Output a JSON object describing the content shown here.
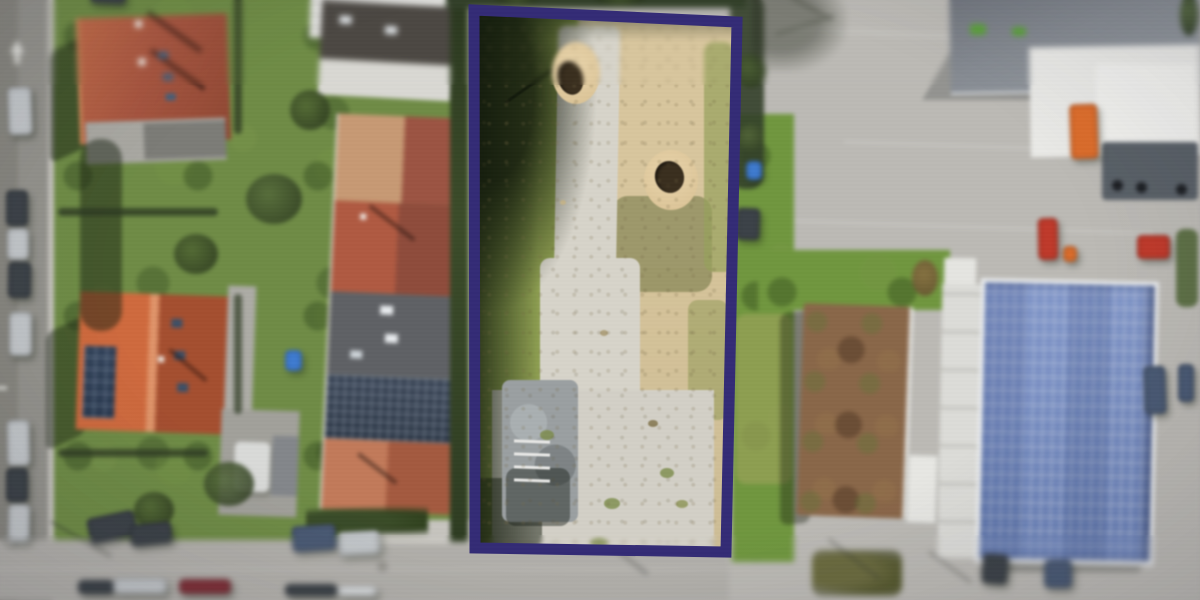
{
  "meta": {
    "description": "Aerial drone photograph of a vacant building plot outlined with a thick purple boundary; residential houses with red roofs and a street with parked cars on the left, commercial yard with a solar-panel roof building on the right"
  },
  "boundary": {
    "points": "474,10 737,22 726,552 475,548",
    "stroke": "#332b76",
    "stroke_width": 11
  },
  "palette": {
    "boundary_purple": "#332b76",
    "road": "#b3b1ac",
    "road_left": "#94938d",
    "sidewalk": "#c7c5bf",
    "pavement": "#bcbab5",
    "grass": "#6f8c46",
    "grass_bright": "#70973f",
    "grass_pale": "#96a156",
    "hedge": "#2d3a23",
    "tree_dark": "#33402a",
    "plot_grass": "#8da050",
    "plot_shadow": "#1e2a17",
    "gravel": "#d7d4ca",
    "sand": "#d8c69e",
    "sand_mound": "#e8d4ab",
    "pit_hole": "#3a2f1f",
    "rubble": "#9ba0a2",
    "roof_red": "#a85a3e",
    "roof_orange": "#c2623a",
    "roof_tan": "#c79a74",
    "roof_darkred": "#9c5443",
    "roof_darkgray": "#45474b",
    "roof_gray": "#5f6165",
    "roof_slate": "#868b92",
    "white_bldg": "#e9e9e6",
    "solar_panel": "#7d92c4",
    "solar_line": "#b9c4dd",
    "greenroof": "#8a6749",
    "truck_orange": "#dc6d2c",
    "vehicle_red": "#bf3a2b",
    "car_silver": "#c3c7ca",
    "car_dark": "#3c4248",
    "car_blue": "#4a5a74",
    "car_maroon": "#7f3038",
    "car_white": "#dde0e2",
    "object_blue": "#3f7bd0"
  },
  "vehicles": [
    {
      "name": "parked-car",
      "x": 14,
      "y": 93,
      "w": 24,
      "h": 48,
      "c": "car_silver",
      "r": -2
    },
    {
      "name": "parked-car",
      "x": 12,
      "y": 196,
      "w": 22,
      "h": 36,
      "c": "car_dark",
      "r": 0
    },
    {
      "name": "parked-car",
      "x": 13,
      "y": 234,
      "w": 22,
      "h": 32,
      "c": "car_silver",
      "r": 0
    },
    {
      "name": "parked-car",
      "x": 14,
      "y": 268,
      "w": 23,
      "h": 36,
      "c": "car_dark",
      "r": 1
    },
    {
      "name": "parked-car",
      "x": 15,
      "y": 318,
      "w": 23,
      "h": 44,
      "c": "car_silver",
      "r": 0
    },
    {
      "name": "parked-car",
      "x": 13,
      "y": 426,
      "w": 23,
      "h": 46,
      "c": "car_silver",
      "r": -1
    },
    {
      "name": "parked-car",
      "x": 12,
      "y": 474,
      "w": 22,
      "h": 34,
      "c": "car_dark",
      "r": 0
    },
    {
      "name": "parked-car",
      "x": 14,
      "y": 510,
      "w": 22,
      "h": 38,
      "c": "car_silver",
      "r": 1
    },
    {
      "name": "parked-car",
      "x": 96,
      "y": -8,
      "w": 36,
      "h": 18,
      "c": "car_dark",
      "r": 3
    },
    {
      "name": "parked-car",
      "x": 94,
      "y": 520,
      "w": 48,
      "h": 26,
      "c": "car_dark",
      "r": -12
    },
    {
      "name": "parked-car",
      "x": 136,
      "y": 529,
      "w": 42,
      "h": 22,
      "c": "car_dark",
      "r": -6
    },
    {
      "name": "parked-car",
      "x": 298,
      "y": 531,
      "w": 44,
      "h": 26,
      "c": "car_blue",
      "r": -4
    },
    {
      "name": "parked-car",
      "x": 344,
      "y": 537,
      "w": 42,
      "h": 24,
      "c": "car_silver",
      "r": -3
    },
    {
      "name": "parked-car",
      "x": 84,
      "y": 586,
      "w": 36,
      "h": 14,
      "c": "car_dark",
      "r": 0
    },
    {
      "name": "parked-car",
      "x": 119,
      "y": 584,
      "w": 54,
      "h": 16,
      "c": "car_silver",
      "r": 0
    },
    {
      "name": "parked-car",
      "x": 185,
      "y": 585,
      "w": 52,
      "h": 15,
      "c": "car_maroon",
      "r": 0
    },
    {
      "name": "parked-car",
      "x": 291,
      "y": 590,
      "w": 52,
      "h": 12,
      "c": "car_dark",
      "r": 0
    },
    {
      "name": "parked-car",
      "x": 343,
      "y": 592,
      "w": 40,
      "h": 10,
      "c": "car_white",
      "r": 0
    },
    {
      "name": "parked-car",
      "x": 988,
      "y": 560,
      "w": 26,
      "h": 30,
      "c": "car_dark",
      "r": 4
    },
    {
      "name": "parked-car",
      "x": 1050,
      "y": 566,
      "w": 28,
      "h": 28,
      "c": "car_blue",
      "r": 0
    },
    {
      "name": "parked-car",
      "x": 1150,
      "y": 372,
      "w": 22,
      "h": 48,
      "c": "car_blue",
      "r": -2
    },
    {
      "name": "parked-car",
      "x": 1184,
      "y": 370,
      "w": 16,
      "h": 38,
      "c": "car_blue",
      "r": 0
    },
    {
      "name": "red-car",
      "x": 1044,
      "y": 224,
      "w": 20,
      "h": 42,
      "c": "vehicle_red",
      "r": -1
    },
    {
      "name": "red-truck",
      "x": 1143,
      "y": 241,
      "w": 33,
      "h": 24,
      "c": "vehicle_red",
      "r": 0
    },
    {
      "name": "orange-car",
      "x": 1069,
      "y": 252,
      "w": 14,
      "h": 16,
      "c": "truck_orange",
      "r": 0
    },
    {
      "name": "orange-truck",
      "x": 1076,
      "y": 110,
      "w": 28,
      "h": 55,
      "c": "truck_orange",
      "r": -2
    },
    {
      "name": "blue-bin",
      "x": 752,
      "y": 167,
      "w": 16,
      "h": 19,
      "c": "object_blue",
      "r": 0
    },
    {
      "name": "dark-bins",
      "x": 742,
      "y": 214,
      "w": 24,
      "h": 32,
      "c": "car_dark",
      "r": 2
    },
    {
      "name": "garden-object",
      "x": 291,
      "y": 356,
      "w": 17,
      "h": 21,
      "c": "object_blue",
      "r": 0
    }
  ],
  "pits": [
    {
      "mx": 552,
      "my": 42,
      "mw": 48,
      "mh": 62,
      "hx": 558,
      "hy": 61,
      "hw": 25,
      "hh": 34
    },
    {
      "mx": 644,
      "my": 150,
      "mw": 54,
      "mh": 60,
      "hx": 655,
      "hy": 161,
      "hw": 29,
      "hh": 32
    }
  ]
}
